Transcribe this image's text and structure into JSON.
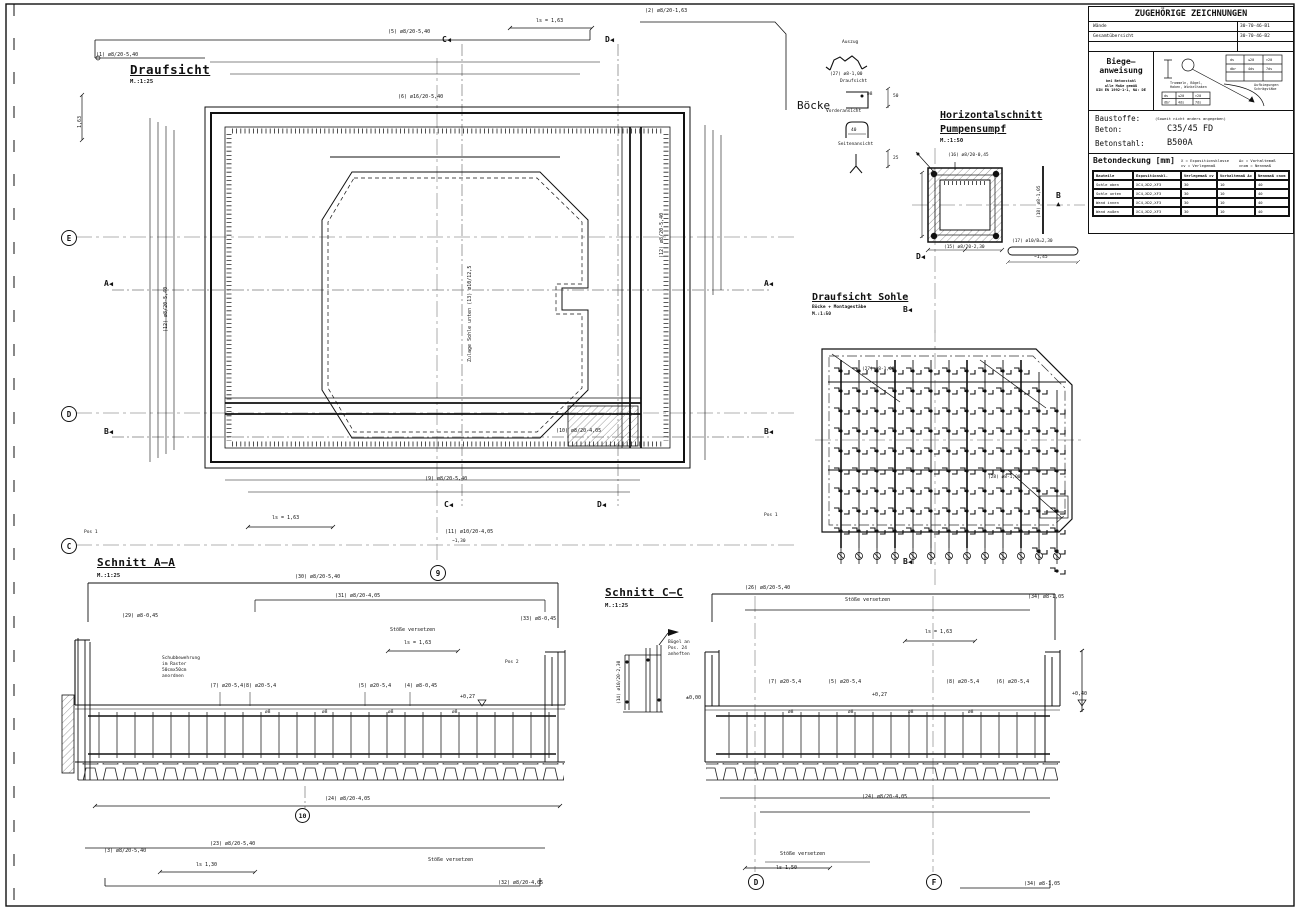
{
  "titleblock": {
    "header": "ZUGEHÖRIGE ZEICHNUNGEN",
    "related": [
      {
        "label": "Wände",
        "number": "30-70-46-B1"
      },
      {
        "label": "Gesamtübersicht",
        "number": "30-70-46-B2"
      }
    ],
    "biegeanweisung": {
      "title1": "Biege—",
      "title2": "anweisung",
      "note1": "bei Betonstahl",
      "note2": "alle Maße gemäß",
      "note3": "DIN EN 1992-1-1, NA: DE",
      "diag1": "Trommeln, Bögel,",
      "diag2": "Haken, Winkelhaken",
      "diag3": "Aufbiegungen",
      "diag4": "Schrägstäbe",
      "t_ds": "ds",
      "t_le20": "≤20",
      "t_gt20": ">20",
      "t_dbr": "dbr",
      "t_4ds": "4ds",
      "t_7ds": "7ds"
    },
    "baustoffe": {
      "label": "Baustoffe:",
      "note": "(Soweit nicht anders angegeben)",
      "beton_label": "Beton:",
      "beton_value": "C35/45 FD",
      "stahl_label": "Betonstahl:",
      "stahl_value": "B500A"
    },
    "betondeckung": {
      "title": "Betondeckung [mm]",
      "legend1": "X = Expositionsklasse",
      "legend2": "cv = Verlegemaß",
      "legend3": "Δc = Vorhaltemaß",
      "legend4": "cnom = Nennmaß",
      "columns": [
        "Bauteile",
        "Expositionskl.",
        "Verlegemaß cv",
        "Vorhaltemaß Δc",
        "Nennmaß cnom"
      ],
      "rows": [
        [
          "Sohle oben",
          "XC4,XD2,XF3",
          "30",
          "10",
          "40"
        ],
        [
          "Sohle unten",
          "XC4,XD2,XF3",
          "30",
          "10",
          "40"
        ],
        [
          "Wand innen",
          "XC4,XD2,XF3",
          "30",
          "10",
          "40"
        ],
        [
          "Wand außen",
          "XC4,XD2,XF3",
          "30",
          "10",
          "40"
        ]
      ]
    }
  },
  "views": {
    "draufsicht": {
      "title": "Draufsicht",
      "scale": "M.:1:25"
    },
    "boecke": {
      "title": "Böcke",
      "auszug": "Auszug",
      "draufsicht": "Draufsicht",
      "vorderansicht": "Vorderansicht",
      "seitenansicht": "Seitenansicht",
      "dim50": "50",
      "dim40": "40",
      "dim25": "25",
      "dia": "ø8"
    },
    "pumpensumpf": {
      "title1": "Horizontalschnitt",
      "title2": "Pumpensumpf",
      "scale": "M.:1:50"
    },
    "sohle": {
      "title": "Draufsicht Sohle",
      "subtitle": "Böcke + Montagestäbe",
      "scale": "M.:1:50"
    },
    "schnitt_aa": {
      "title": "Schnitt A—A",
      "scale": "M.:1:25"
    },
    "schnitt_cc": {
      "title": "Schnitt C—C",
      "scale": "M.:1:25"
    }
  },
  "markers": {
    "a": "A",
    "b": "B",
    "c": "C",
    "d": "D",
    "e": "E",
    "f": "F",
    "n9": "9",
    "n10": "10",
    "tri": "◀",
    "tri_up": "▲"
  },
  "notes": {
    "zulage": "Zulage Sohle unten (13) ø10/12,5",
    "schub1": "Schubbewehrung",
    "schub2": "im Raster",
    "schub3": "50cmx50cm",
    "schub4": "anordnen",
    "buegel1": "Bügel an",
    "buegel2": "Pos. 24",
    "buegel3": "anheften",
    "stoesse": "Stöße versetzen",
    "pos1": "Pos 1",
    "pos2": "Pos 2"
  },
  "dims": {
    "ls163": "ls = 1,63",
    "ls150": "ls  1,50",
    "ls130": "ls  1,30",
    "d163": "1,63",
    "lvl027": "+0,27",
    "lvl040": "+0,40",
    "lvl000": "±0,00",
    "b130": "~1,30",
    "b145": "~1,45"
  },
  "callouts": {
    "c01": "(1) ø8/20-5,40",
    "c02": "(2) ø8/20-1,63",
    "c03": "(3) ø8/20-5,40",
    "c04": "(4) ø8-0,45",
    "c05": "(5) ø8/20-5,40",
    "c05b": "(5) ø20-5,4",
    "c06": "(6) ø16/20-5,40",
    "c06b": "(6) ø20-5,4",
    "c07": "(7) ø20-5,4",
    "c08": "(8) ø20-5,4",
    "c09": "(9) ø8/20-5,40",
    "c10": "(10) ø8/20-4,05",
    "c11": "(11) ø10/20-4,05",
    "c12": "(12) ø8/20-5,40",
    "c14": "(14) ø10/20-2,30",
    "c15": "(15) ø8/20-2,30",
    "c16": "(16) ø8/20-0,45",
    "c17": "(17) ø10/B=2,30",
    "c18": "(18) ø8-1,05",
    "c23": "(23) ø8/20-5,40",
    "c24": "(24) ø8/20-4,05",
    "c26": "(26) ø8/20-5,40",
    "c27": "(27) ø8-1,00",
    "c28": "(28) ø8-1,00",
    "c29": "(29) ø8-0,45",
    "c30": "(30) ø8/20-5,40",
    "c31": "(31) ø8/20-4,05",
    "c32": "(32) ø8/20-4,05",
    "c33": "(33) ø8-0,45",
    "c34": "(34) ø8-1,05",
    "dia8": "ø8"
  }
}
